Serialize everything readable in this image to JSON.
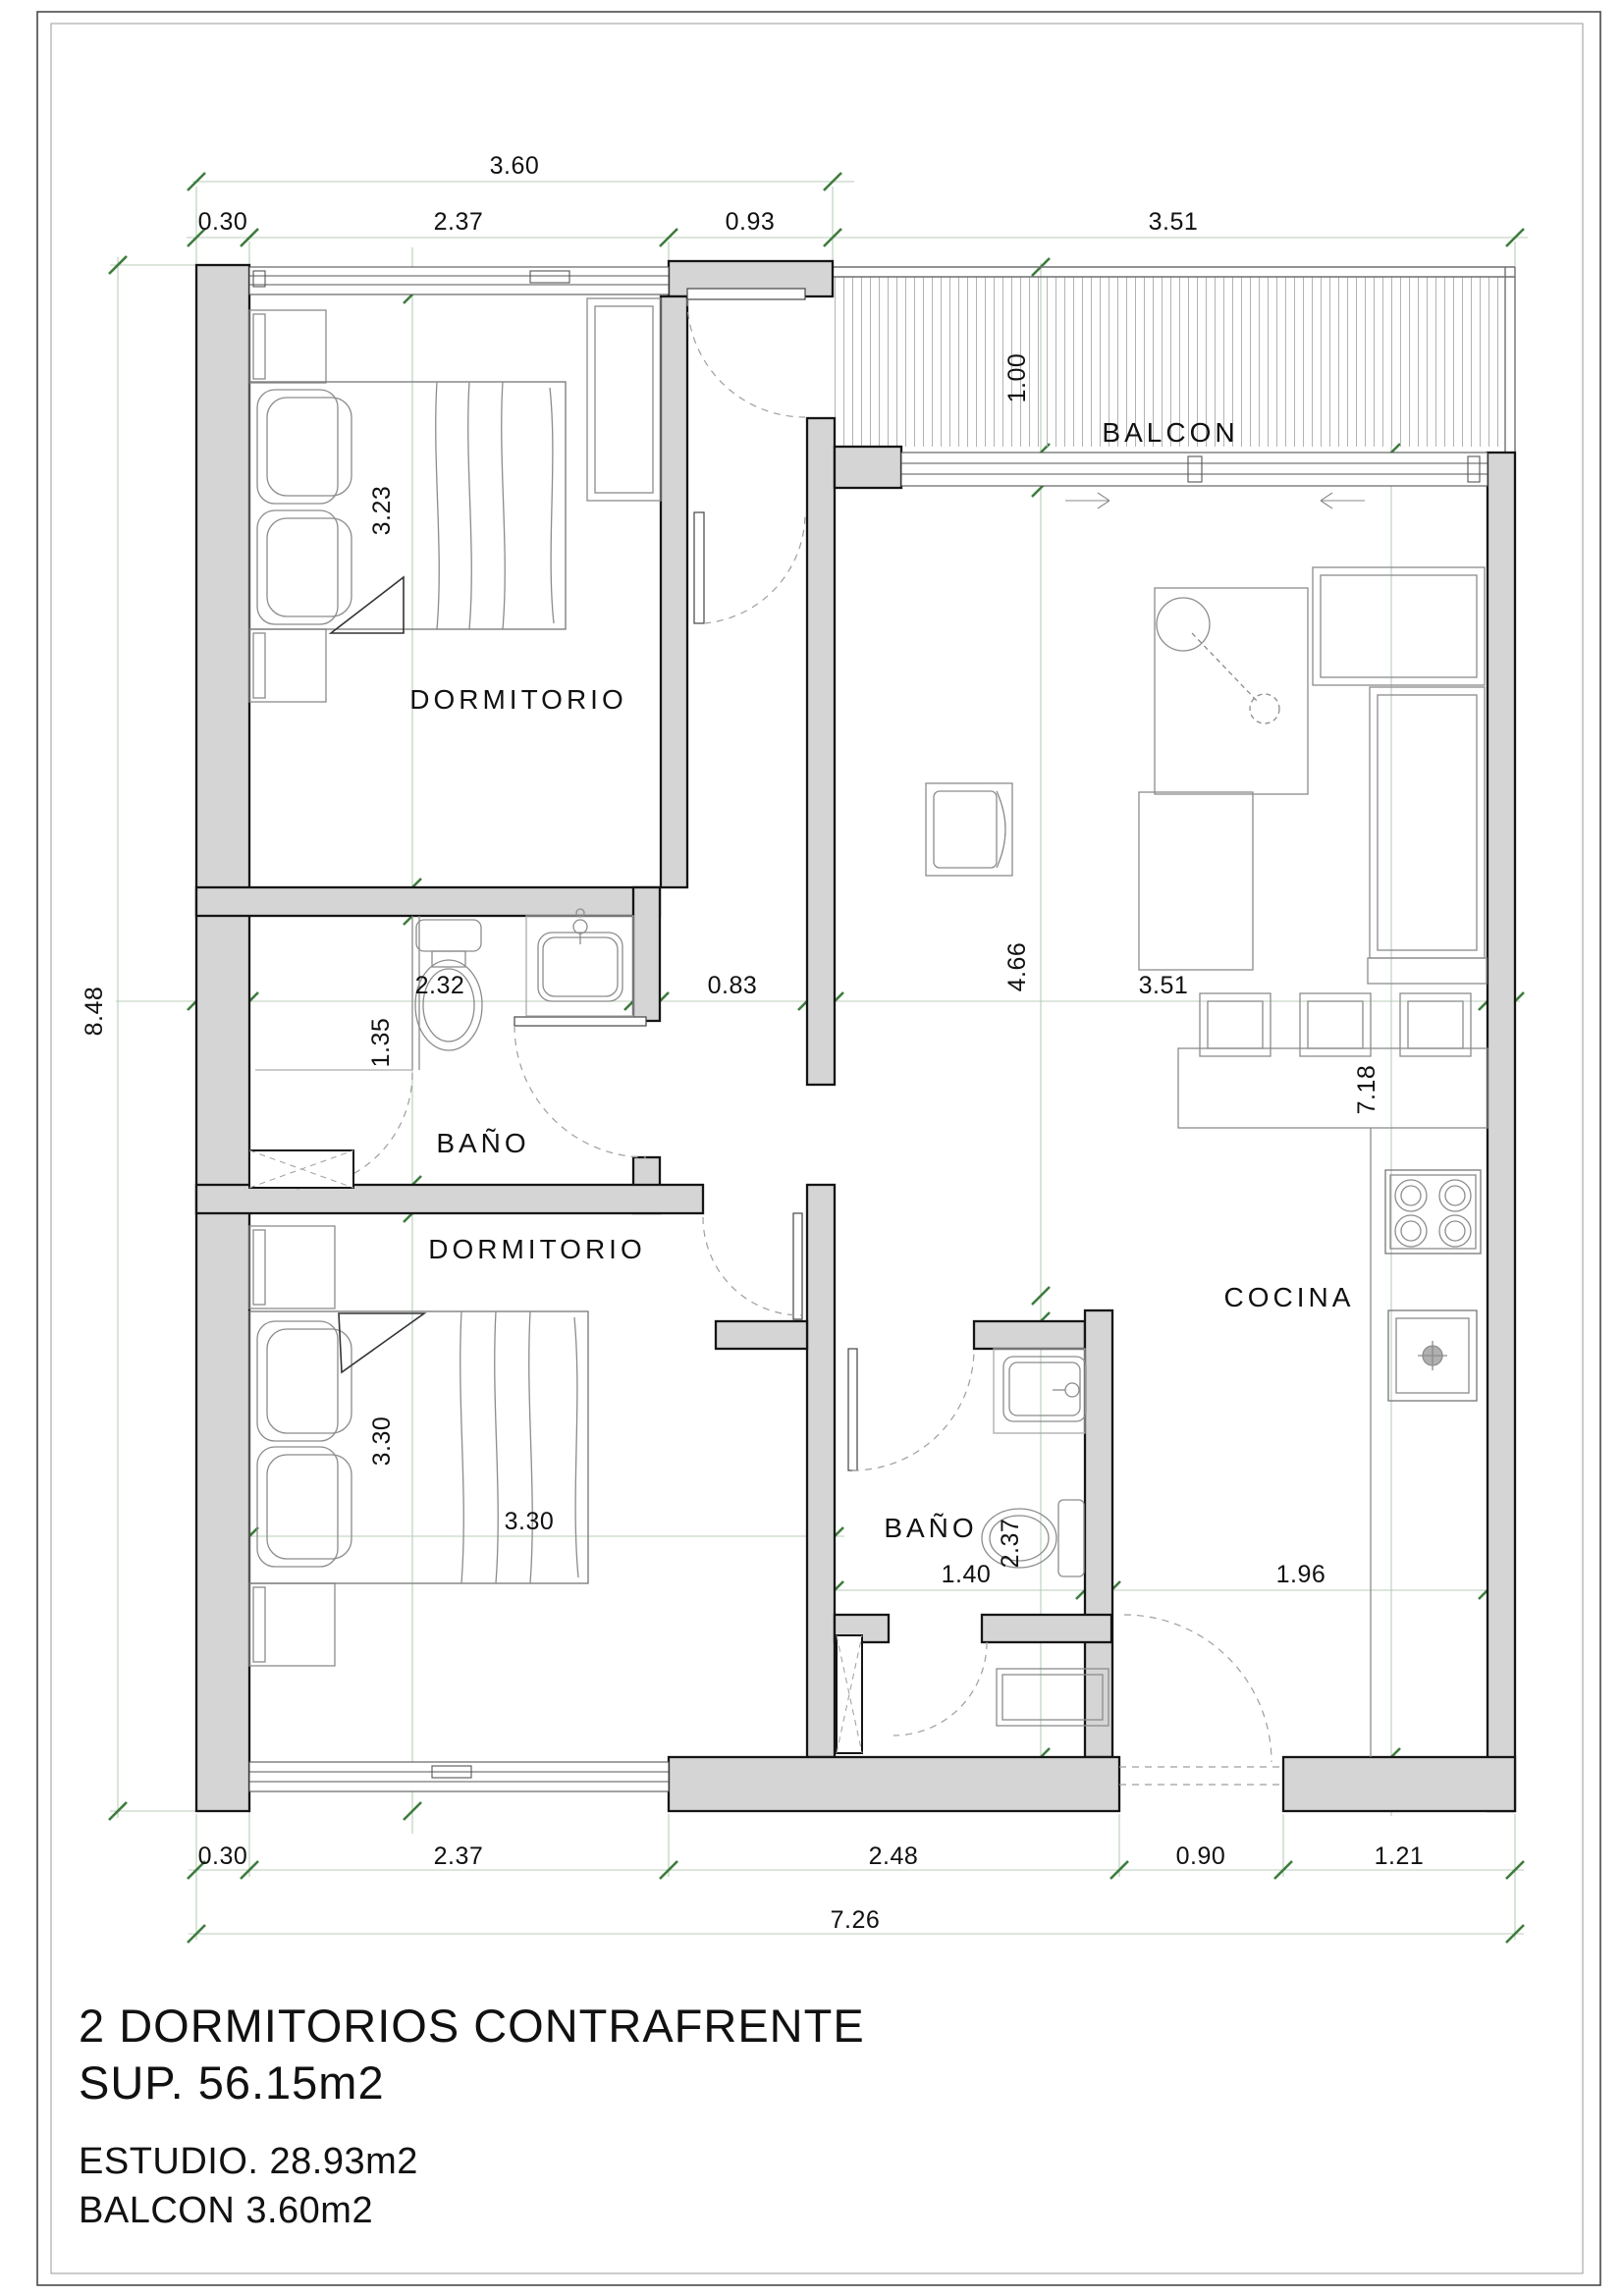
{
  "drawing": {
    "type": "apartment floor plan",
    "rooms": {
      "dormitorio1": "DORMITORIO",
      "dormitorio2": "DORMITORIO",
      "bano1": "BAÑO",
      "bano2": "BAÑO",
      "balcon": "BALCON",
      "cocina": "COCINA"
    },
    "dims": {
      "top_total": "3.60",
      "top_030": "0.30",
      "top_237": "2.37",
      "top_093": "0.93",
      "balcon_w": "3.51",
      "left_total": "8.48",
      "balcon_d": "1.00",
      "bed1_len": "3.23",
      "bath1_w": "2.32",
      "bath1_h": "1.35",
      "hall_w": "0.83",
      "estudio_w": "3.51",
      "estudio_len": "4.66",
      "right_len": "7.18",
      "bed2_len": "3.30",
      "bed2_w": "3.30",
      "bath2_w": "1.40",
      "bath2_len": "2.37",
      "cocina_w": "1.96",
      "bot_030": "0.30",
      "bot_237": "2.37",
      "bot_248": "2.48",
      "bot_090": "0.90",
      "bot_121": "1.21",
      "bot_total": "7.26"
    },
    "title_block": {
      "line1": "2 DORMITORIOS  CONTRAFRENTE",
      "line2": "SUP. 56.15m2",
      "line3": "ESTUDIO. 28.93m2",
      "line4": "BALCON 3.60m2"
    },
    "colors": {
      "wall_fill": "#d5d5d5",
      "wall_stroke": "#151515",
      "dim_tick_green": "#3e7c3e",
      "dim_line_green": "#b9cdb9",
      "furniture_grey": "#8c8c8c",
      "hatch_grey": "#b3b3b3",
      "text": "#111111"
    }
  }
}
